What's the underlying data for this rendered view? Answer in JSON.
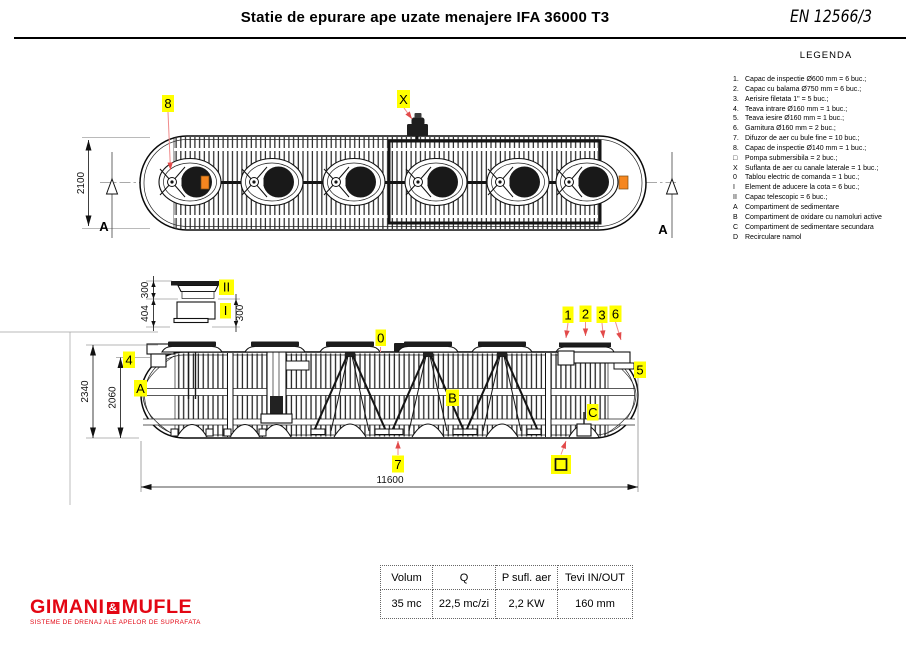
{
  "header": {
    "title": "Statie de epurare ape uzate menajere IFA 36000 T3",
    "standard_ref": "EN 12566/3"
  },
  "legend": {
    "title": "LEGENDA",
    "items": [
      {
        "marker": "1.",
        "text": "Capac de inspectie Ø600 mm = 6 buc.;"
      },
      {
        "marker": "2.",
        "text": "Capac cu balama Ø750 mm = 6 buc.;"
      },
      {
        "marker": "3.",
        "text": "Aerisire filetata 1\" = 5 buc.;"
      },
      {
        "marker": "4.",
        "text": "Teava intrare Ø160 mm = 1 buc.;"
      },
      {
        "marker": "5.",
        "text": "Teava iesire Ø160 mm = 1 buc.;"
      },
      {
        "marker": "6.",
        "text": "Garnitura Ø160 mm = 2 buc.;"
      },
      {
        "marker": "7.",
        "text": "Difuzor de aer cu bule fine = 10 buc.;"
      },
      {
        "marker": "8.",
        "text": "Capac de inspectie Ø140 mm = 1 buc.;"
      },
      {
        "marker": "□",
        "text": "Pompa submersibila = 2 buc.;"
      },
      {
        "marker": "X",
        "text": "Suflanta de aer cu canale laterale = 1 buc.;"
      },
      {
        "marker": "0",
        "text": "Tablou electric de comanda = 1 buc.;"
      },
      {
        "marker": "I",
        "text": "Element de aducere la cota = 6 buc.;"
      },
      {
        "marker": "II",
        "text": "Capac telescopic = 6 buc.;"
      },
      {
        "marker": "A",
        "text": "Compartiment de sedimentare"
      },
      {
        "marker": "B",
        "text": "Compartiment de oxidare cu namoluri active"
      },
      {
        "marker": "C",
        "text": "Compartiment de sedimentare secundara"
      },
      {
        "marker": "D",
        "text": "Recirculare namol"
      }
    ]
  },
  "top_view": {
    "dim_width_label": "2100",
    "section_label": "A",
    "callouts": {
      "c8": "8",
      "cx": "X"
    }
  },
  "detail_view": {
    "dims": {
      "top": "300",
      "total": "404",
      "right": "300"
    },
    "callouts": {
      "telescopic": "II",
      "element": "I"
    }
  },
  "side_view": {
    "dims": {
      "height_total": "2340",
      "height_tank": "2060",
      "length": "11600"
    },
    "callouts": {
      "c1": "1",
      "c2": "2",
      "c3": "3",
      "c4": "4",
      "c5": "5",
      "c6": "6",
      "c7": "7",
      "c0": "0",
      "compartment_a": "A",
      "compartment_b": "B",
      "compartment_c": "C"
    }
  },
  "spec_table": {
    "headers": [
      "Volum",
      "Q",
      "P sufl. aer",
      "Tevi IN/OUT"
    ],
    "values": [
      "35 mc",
      "22,5 mc/zi",
      "2,2 KW",
      "160 mm"
    ]
  },
  "logo": {
    "name_left": "GIMANI",
    "amp": "&",
    "name_right": "MUFLE",
    "tagline": "SISTEME DE DRENAJ ALE APELOR DE SUPRAFATA",
    "brand_color": "#e30613"
  }
}
